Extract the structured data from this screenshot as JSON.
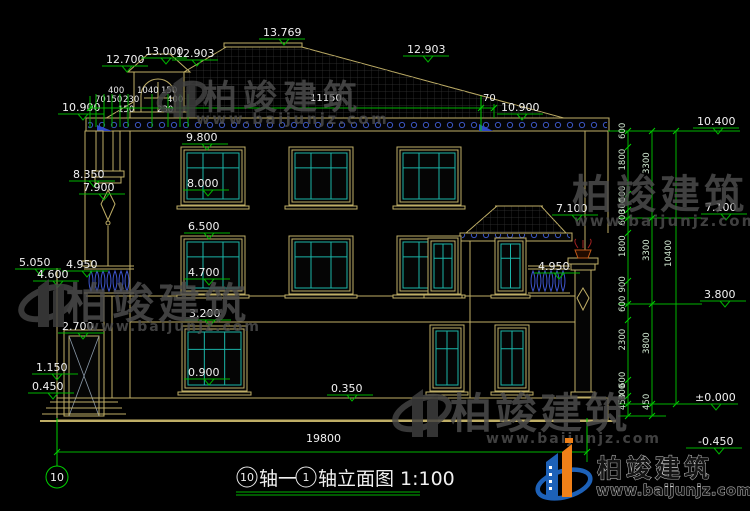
{
  "brand": {
    "name": "柏竣建筑",
    "url": "www.baijunjz.com"
  },
  "axis_bubble": {
    "left": "10"
  },
  "titlebar": {
    "axis_left": "10",
    "seg1": "轴一",
    "axis_right": "1",
    "seg2": "轴立面图",
    "scale": "1:100"
  },
  "dims": {
    "top": {
      "cupola_eave": "12.700",
      "cupola_ridge": "13.000",
      "ridge_left": "12.903",
      "peak": "13.769",
      "slope_right": "12.903",
      "eave_left": "10.900",
      "eave_right": "10.900",
      "eave_length": "11150",
      "overhang": "70"
    },
    "top_small": [
      "400",
      "1040",
      "150",
      "70",
      "150",
      "230",
      "400",
      "150",
      "230"
    ],
    "left": {
      "l1": "9.800",
      "l2": "8.350",
      "l3": "7.900",
      "l4": "8.000",
      "l5": "6.500",
      "l6": "5.050",
      "l7": "4.950",
      "l8": "4.600",
      "l9": "4.700",
      "l10": "3.200",
      "l11": "2.700",
      "l12": "1.150",
      "l13": "0.450",
      "l14": "0.900",
      "l15": "0.350"
    },
    "right_inner": {
      "porch_roof": "7.100",
      "porch_rail": "4.950"
    },
    "right_margin": {
      "m1": "10.400",
      "m2": "7.100",
      "m3": "3.800",
      "m4": "±0.000",
      "m5": "-0.450"
    },
    "chain_a": [
      "600",
      "1800",
      "600",
      "300",
      "600",
      "1800",
      "900",
      "600",
      "2300",
      "600",
      "300",
      "450"
    ],
    "chain_b": [
      "3300",
      "3300",
      "3800",
      "450"
    ],
    "chain_c": [
      "10400"
    ],
    "total_width": "19800"
  }
}
